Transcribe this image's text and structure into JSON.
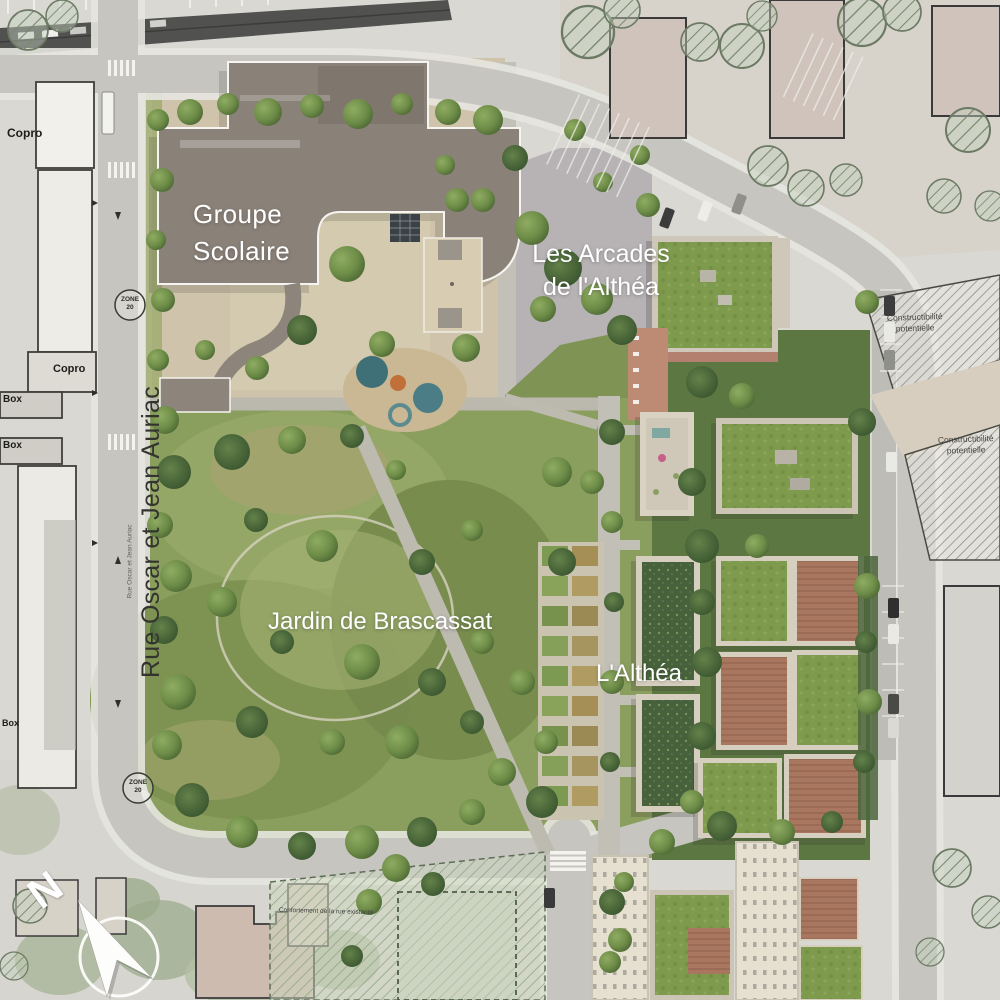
{
  "plan": {
    "project_labels": {
      "school_line1": "Groupe",
      "school_line2": "Scolaire",
      "arcades_line1": "Les Arcades",
      "arcades_line2": "de l'Althéa",
      "garden": "Jardin de Brascassat",
      "althea": "L'Althéa"
    },
    "street": {
      "main": "Rue Oscar et Jean Auriac",
      "small": "Rue Oscar et Jean Auriac"
    },
    "context_labels": {
      "copro_top": "Copro",
      "copro_mid": "Copro",
      "box_1": "Box",
      "box_2": "Box",
      "box_3": "Box",
      "constructible_upper_line1": "Constructibilité",
      "constructible_upper_line2": "potentielle",
      "constructible_lower_line1": "Constructibilité",
      "constructible_lower_line2": "potentielle",
      "road_note": "Confortement de la rue existante"
    },
    "road_markings": {
      "zone_top_line1": "ZONE",
      "zone_top_line2": "20",
      "zone_bottom_line1": "ZONE",
      "zone_bottom_line2": "20"
    },
    "compass": {
      "north": "N"
    },
    "colors": {
      "park_green": "#8a9e5e",
      "roof_green": "#7e9a4d",
      "planted_roof": "#46613b",
      "school_roof": "#8a8178",
      "terracotta": "#b3806f",
      "cream_facade": "#e6e0d1",
      "schoolyard_beige": "#cfc4ab",
      "road_gray": "#c6c5c0",
      "aerial_context": "#d9d8d3",
      "railway_dark": "#515150",
      "label_white": "#ffffff"
    }
  }
}
